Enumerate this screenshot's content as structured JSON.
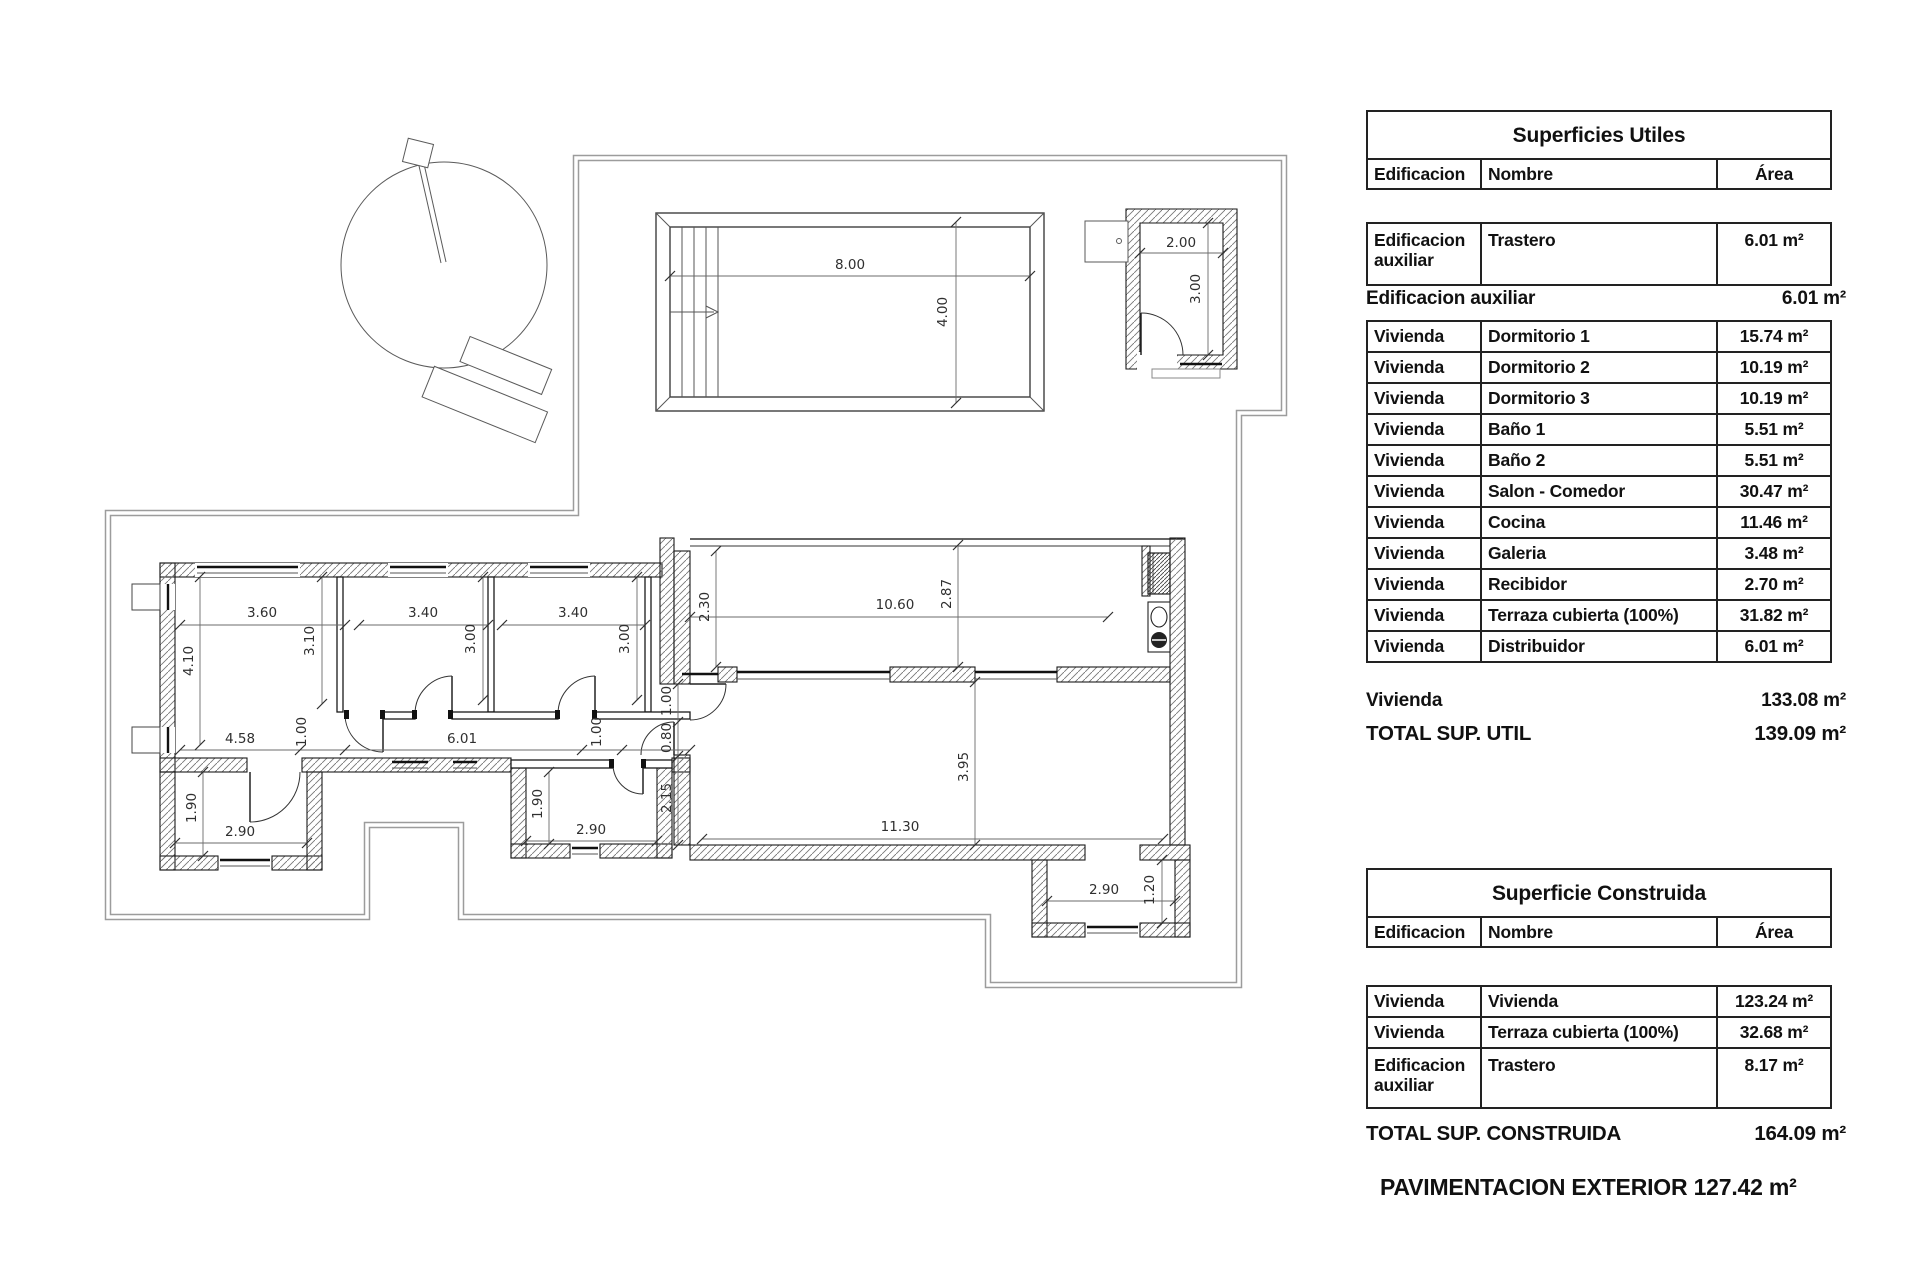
{
  "plan": {
    "dims": {
      "pool_width": "8.00",
      "pool_height": "4.00",
      "trastero_width": "2.00",
      "trastero_height": "3.00",
      "dorm1_width": "3.60",
      "dorm2_width": "3.40",
      "dorm3_width": "3.40",
      "dorm1_height": "4.10",
      "dorm1_inner_height": "3.10",
      "dorm2_height": "3.00",
      "dorm3_height": "3.00",
      "hall_left": "4.58",
      "hall_door_left": "1.00",
      "hall_length": "6.01",
      "hall_door_right": "1.00",
      "bath1_height": "1.90",
      "bath1_width": "2.90",
      "bath2_height": "1.90",
      "bath2_width": "2.90",
      "entry_door": "1.00",
      "entry_door2": "0.80",
      "entry_wall": "2.15",
      "terraza_depth_left": "2.30",
      "terraza_length": "10.60",
      "terraza_depth_right": "2.87",
      "salon_length": "11.30",
      "salon_depth": "3.95",
      "porch_width": "2.90",
      "porch_depth": "1.20"
    }
  },
  "tables": {
    "utiles": {
      "title": "Superficies Utiles",
      "columns": {
        "edificacion": "Edificacion",
        "nombre": "Nombre",
        "area": "Área"
      },
      "first_row": {
        "edificacion": "Edificacion auxiliar",
        "nombre": "Trastero",
        "area": "6.01 m²"
      },
      "subtotal_aux": {
        "label": "Edificacion auxiliar",
        "value": "6.01 m²"
      },
      "rows": [
        {
          "edificacion": "Vivienda",
          "nombre": "Dormitorio 1",
          "area": "15.74 m²"
        },
        {
          "edificacion": "Vivienda",
          "nombre": "Dormitorio 2",
          "area": "10.19 m²"
        },
        {
          "edificacion": "Vivienda",
          "nombre": "Dormitorio 3",
          "area": "10.19 m²"
        },
        {
          "edificacion": "Vivienda",
          "nombre": "Baño 1",
          "area": "5.51 m²"
        },
        {
          "edificacion": "Vivienda",
          "nombre": "Baño 2",
          "area": "5.51 m²"
        },
        {
          "edificacion": "Vivienda",
          "nombre": "Salon - Comedor",
          "area": "30.47 m²"
        },
        {
          "edificacion": "Vivienda",
          "nombre": "Cocina",
          "area": "11.46 m²"
        },
        {
          "edificacion": "Vivienda",
          "nombre": "Galeria",
          "area": "3.48 m²"
        },
        {
          "edificacion": "Vivienda",
          "nombre": "Recibidor",
          "area": "2.70 m²"
        },
        {
          "edificacion": "Vivienda",
          "nombre": "Terraza cubierta (100%)",
          "area": "31.82 m²"
        },
        {
          "edificacion": "Vivienda",
          "nombre": "Distribuidor",
          "area": "6.01 m²"
        }
      ],
      "subtotal_viv": {
        "label": "Vivienda",
        "value": "133.08 m²"
      },
      "total": {
        "label": "TOTAL SUP. UTIL",
        "value": "139.09 m²"
      }
    },
    "construida": {
      "title": "Superficie Construida",
      "columns": {
        "edificacion": "Edificacion",
        "nombre": "Nombre",
        "area": "Área"
      },
      "rows": [
        {
          "edificacion": "Vivienda",
          "nombre": "Vivienda",
          "area": "123.24 m²"
        },
        {
          "edificacion": "Vivienda",
          "nombre": "Terraza cubierta (100%)",
          "area": "32.68 m²"
        },
        {
          "edificacion": "Edificacion auxiliar",
          "nombre": "Trastero",
          "area": "8.17 m²"
        }
      ],
      "total": {
        "label": "TOTAL SUP. CONSTRUIDA",
        "value": "164.09 m²"
      }
    },
    "footer": "PAVIMENTACION EXTERIOR 127.42 m²"
  }
}
